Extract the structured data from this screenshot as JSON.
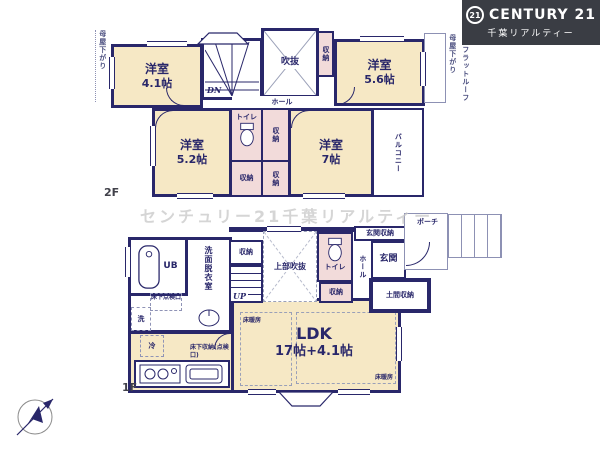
{
  "logo": {
    "badge": "21",
    "brand": "CENTURY 21",
    "subtitle": "千葉リアルティー",
    "bg_color": "#3a3d44"
  },
  "watermark": "センチュリー21千葉リアルティー",
  "floor2": {
    "label": "2F",
    "room41_name": "洋室",
    "room41_size": "4.1帖",
    "room56_name": "洋室",
    "room56_size": "5.6帖",
    "room52_name": "洋室",
    "room52_size": "5.2帖",
    "room7_name": "洋室",
    "room7_size": "7帖",
    "void": "吹抜",
    "hall": "ホール",
    "toilet": "トイレ",
    "storage": "収納",
    "balcony": "バルコニー",
    "down": "DN",
    "eaves": "母屋下がり",
    "flat_roof": "フラットルーフ"
  },
  "floor1": {
    "label": "1F",
    "ldk_name": "LDK",
    "ldk_size": "17帖+4.1帖",
    "unit_bath": "UB",
    "washroom": "洗面脱衣室",
    "upper_void": "上部吹抜",
    "toilet": "トイレ",
    "storage": "収納",
    "hall": "ホール",
    "entrance": "玄関",
    "entrance_storage": "玄関収納",
    "dirt_storage": "土間収納",
    "porch": "ポーチ",
    "up": "UP",
    "floor_heating": "床暖房",
    "underfloor_hatch": "床下点検口",
    "underfloor_storage": "床下収納(点検口)",
    "fridge": "冷",
    "washer": "洗"
  },
  "colors": {
    "wall": "#29276a",
    "room_cream": "#f6e8c5",
    "room_pink": "#f2dbda",
    "logo_bg": "#3a3d44"
  }
}
